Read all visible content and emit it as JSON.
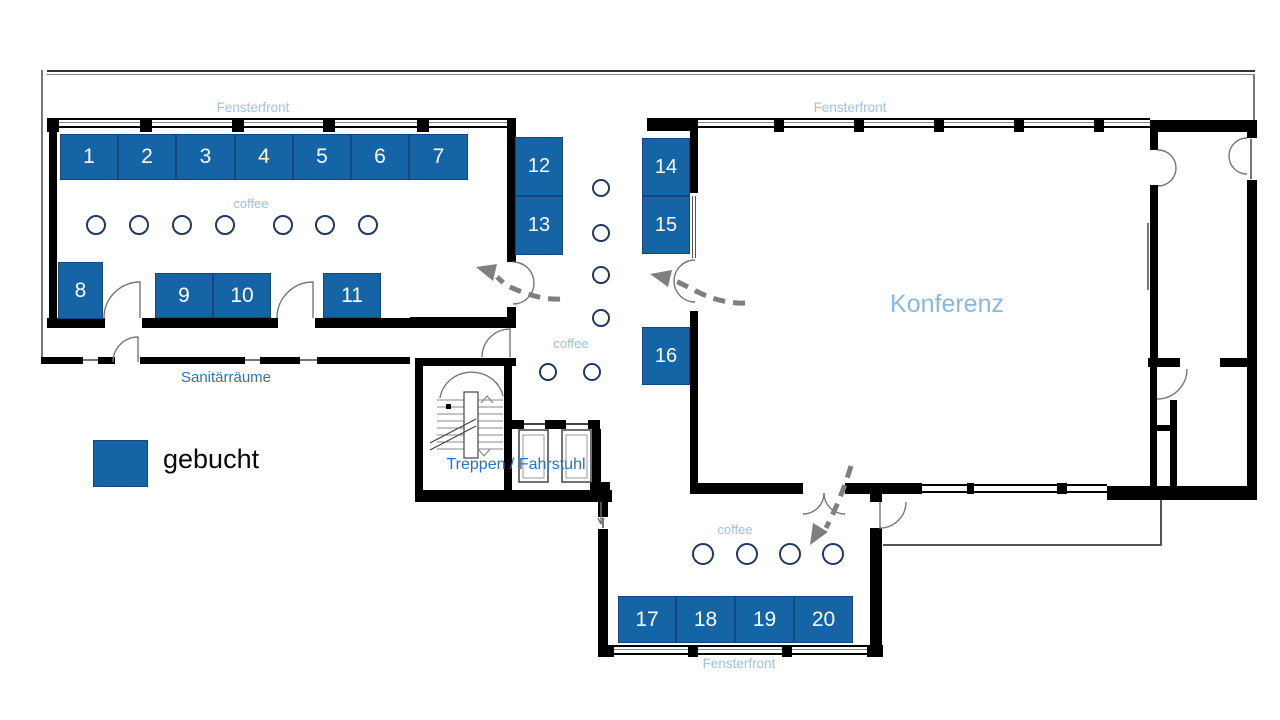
{
  "plan": {
    "legend": {
      "label": "gebucht",
      "swatch_color": "#1464A6"
    },
    "rooms": {
      "konferenz": "Konferenz",
      "sanitaerraeume": "Sanitärräume",
      "treppen_fahrstuhl": "Treppen / Fahrstuhl"
    },
    "window_labels": {
      "top_left": "Fensterfront",
      "top_right": "Fensterfront",
      "bottom": "Fensterfront"
    },
    "coffee_labels": {
      "left_room": "coffee",
      "corridor": "coffee",
      "bottom_room": "coffee"
    },
    "booths": {
      "status": "gebucht",
      "items": [
        {
          "label": "1"
        },
        {
          "label": "2"
        },
        {
          "label": "3"
        },
        {
          "label": "4"
        },
        {
          "label": "5"
        },
        {
          "label": "6"
        },
        {
          "label": "7"
        },
        {
          "label": "8"
        },
        {
          "label": "9"
        },
        {
          "label": "10"
        },
        {
          "label": "11"
        },
        {
          "label": "12"
        },
        {
          "label": "13"
        },
        {
          "label": "14"
        },
        {
          "label": "15"
        },
        {
          "label": "16"
        },
        {
          "label": "17"
        },
        {
          "label": "18"
        },
        {
          "label": "19"
        },
        {
          "label": "20"
        }
      ]
    },
    "colors": {
      "booth_fill": "#1464A6",
      "booth_border": "#17457E",
      "chair_outline": "#1F3864",
      "label_light_blue": "#9DC3E6",
      "konferenz_label": "#89B8E2",
      "label_medium_blue": "#2E74B5",
      "arrow_gray": "#7F7F7F",
      "wall": "#000000"
    }
  }
}
